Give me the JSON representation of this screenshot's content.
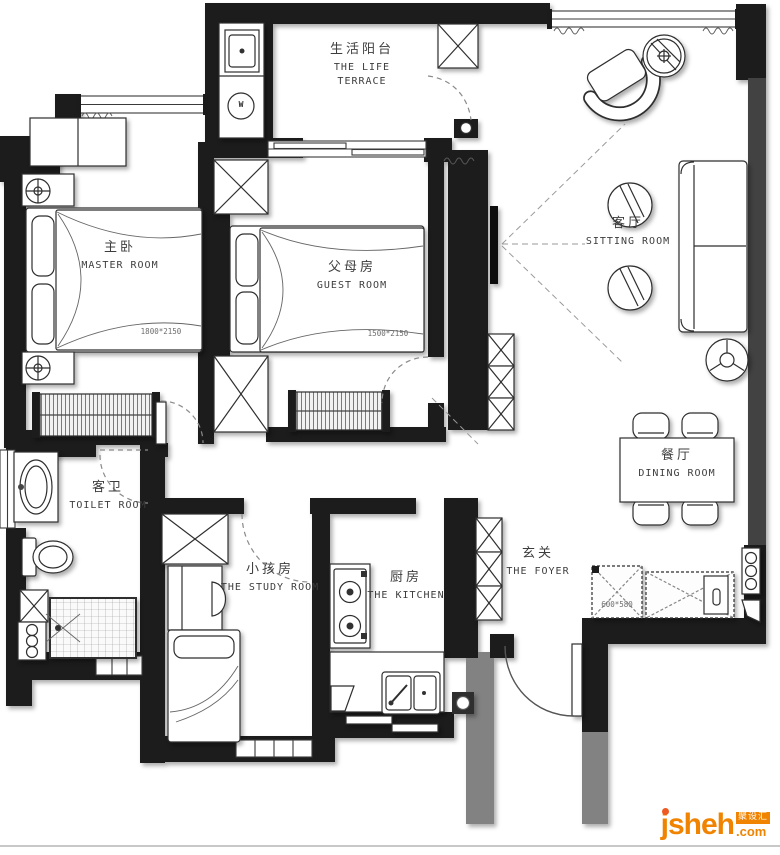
{
  "rooms": {
    "terrace": {
      "zh": "生活阳台",
      "en_line1": "THE LIFE",
      "en_line2": "TERRACE"
    },
    "master": {
      "zh": "主卧",
      "en": "MASTER ROOM",
      "bed_dim": "1800*2150"
    },
    "guest": {
      "zh": "父母房",
      "en": "GUEST ROOM",
      "bed_dim": "1500*2150"
    },
    "sitting": {
      "zh": "客厅",
      "en": "SITTING ROOM"
    },
    "dining": {
      "zh": "餐厅",
      "en": "DINING ROOM"
    },
    "toilet": {
      "zh": "客卫",
      "en": "TOILET ROOM"
    },
    "study": {
      "zh": "小孩房",
      "en": "THE STUDY ROOM"
    },
    "kitchen": {
      "zh": "厨房",
      "en": "THE KITCHEN"
    },
    "foyer": {
      "zh": "玄关",
      "en": "THE FOYER",
      "cabinet_dim": "600*580"
    }
  },
  "appliances": {
    "washer_label": "W"
  },
  "logo": {
    "brand": "jsheh",
    "tld": ".com",
    "badge": "聚设汇",
    "color": "#f08300"
  }
}
